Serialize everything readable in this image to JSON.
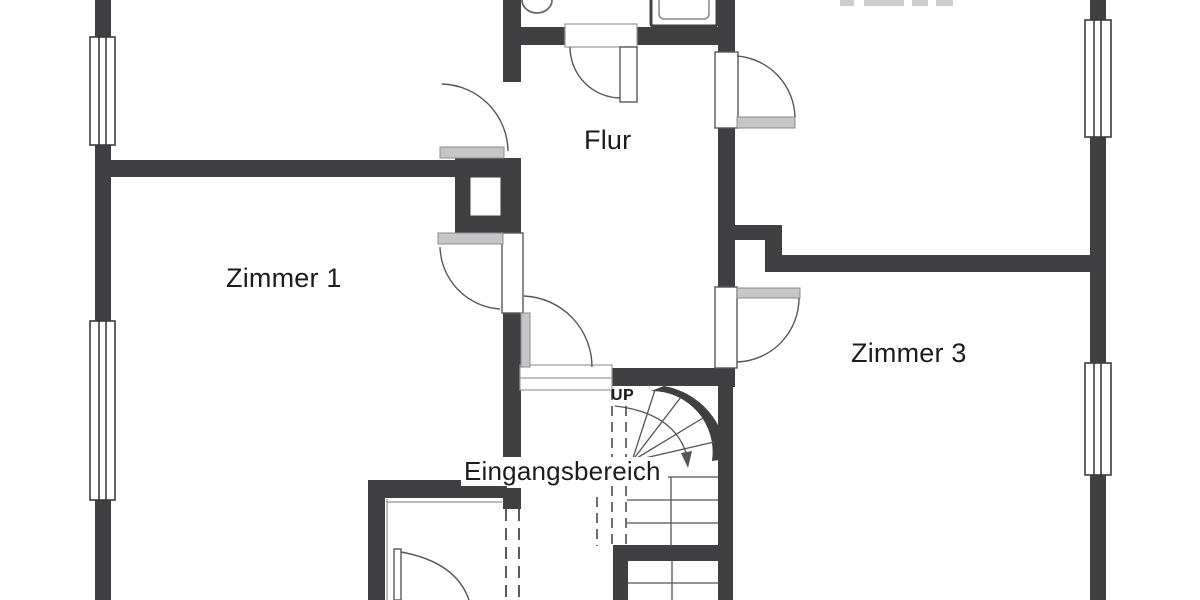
{
  "document": {
    "type": "architectural floor plan, black-and-white, cropped at top and bottom edges"
  },
  "rooms": [
    {
      "id": "flur",
      "label": "Flur"
    },
    {
      "id": "zimmer1",
      "label": "Zimmer 1"
    },
    {
      "id": "zimmer3",
      "label": "Zimmer 3"
    },
    {
      "id": "eingangsbereich",
      "label": "Eingangsbereich"
    }
  ],
  "stairs": {
    "direction_label": "UP",
    "type": "winder staircase with curved wall, straight flights below, walk-line arrow"
  },
  "features": {
    "windows": "double-line window symbols in left and right exterior walls (2 each)",
    "doors": "swing doors with quarter-circle arcs into Flur, Zimmer 1, Zimmer 3, upper rooms, and lower room",
    "fixtures": "toilet and washbasin partially visible at top edge (bathroom cut off)",
    "dashed_lines": "dashed openings at entrance area and stair headroom edge",
    "clipped_label": "room label at top edge cut off by image crop (only letter bottoms visible)"
  },
  "colors": {
    "wall": "#404042",
    "thin_line": "#4a4a4c",
    "door_leaf_gray": "#c6c6c8",
    "label_fragment_gray": "#cdcdcf",
    "background": "#ffffff",
    "text": "#1c1c1e"
  }
}
